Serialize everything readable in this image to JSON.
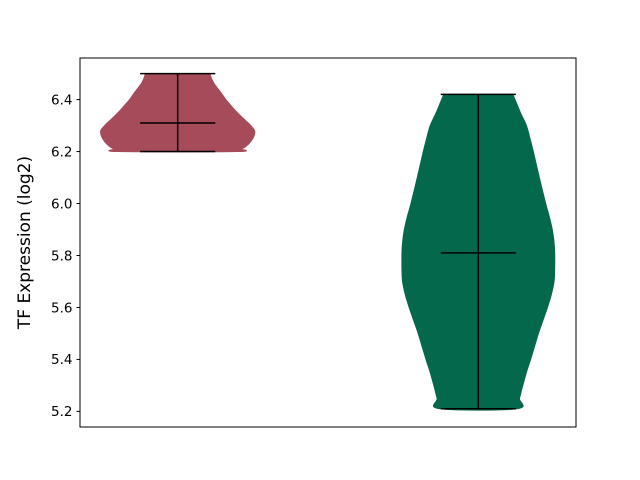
{
  "figure": {
    "background": "#ffffff",
    "axis_color": "#000000"
  },
  "chart_data": {
    "type": "violin",
    "title": "",
    "xlabel": "",
    "ylabel": "TF Expression (log2)",
    "yticks": [
      6.4,
      6.2,
      6.0,
      5.8,
      5.6,
      5.4,
      5.2
    ],
    "xticks": [],
    "ylim": [
      5.14,
      6.56
    ],
    "xlim": [
      0.675,
      2.325
    ],
    "grid": false,
    "legend": false,
    "line_color": "#000000",
    "cap_halfwidth": 0.125,
    "series": [
      {
        "position": 1,
        "color": "#a54b5a",
        "min": 6.2,
        "max": 6.5,
        "median": 6.31,
        "profile": [
          [
            6.5,
            0.107
          ],
          [
            6.48,
            0.113
          ],
          [
            6.46,
            0.122
          ],
          [
            6.44,
            0.135
          ],
          [
            6.42,
            0.148
          ],
          [
            6.4,
            0.16
          ],
          [
            6.38,
            0.175
          ],
          [
            6.36,
            0.19
          ],
          [
            6.34,
            0.207
          ],
          [
            6.32,
            0.225
          ],
          [
            6.3,
            0.243
          ],
          [
            6.28,
            0.256
          ],
          [
            6.26,
            0.254
          ],
          [
            6.24,
            0.244
          ],
          [
            6.22,
            0.227
          ],
          [
            6.21,
            0.212
          ],
          [
            6.2,
            0.195
          ]
        ]
      },
      {
        "position": 2,
        "color": "#04694c",
        "min": 5.21,
        "max": 6.42,
        "median": 5.81,
        "profile": [
          [
            6.42,
            0.115
          ],
          [
            6.35,
            0.14
          ],
          [
            6.3,
            0.16
          ],
          [
            6.25,
            0.172
          ],
          [
            6.2,
            0.183
          ],
          [
            6.1,
            0.203
          ],
          [
            6.0,
            0.224
          ],
          [
            5.95,
            0.236
          ],
          [
            5.9,
            0.246
          ],
          [
            5.85,
            0.252
          ],
          [
            5.81,
            0.254
          ],
          [
            5.75,
            0.254
          ],
          [
            5.7,
            0.252
          ],
          [
            5.65,
            0.243
          ],
          [
            5.6,
            0.23
          ],
          [
            5.55,
            0.215
          ],
          [
            5.5,
            0.2
          ],
          [
            5.45,
            0.187
          ],
          [
            5.4,
            0.174
          ],
          [
            5.35,
            0.16
          ],
          [
            5.3,
            0.148
          ],
          [
            5.25,
            0.137
          ],
          [
            5.21,
            0.128
          ]
        ]
      }
    ]
  }
}
